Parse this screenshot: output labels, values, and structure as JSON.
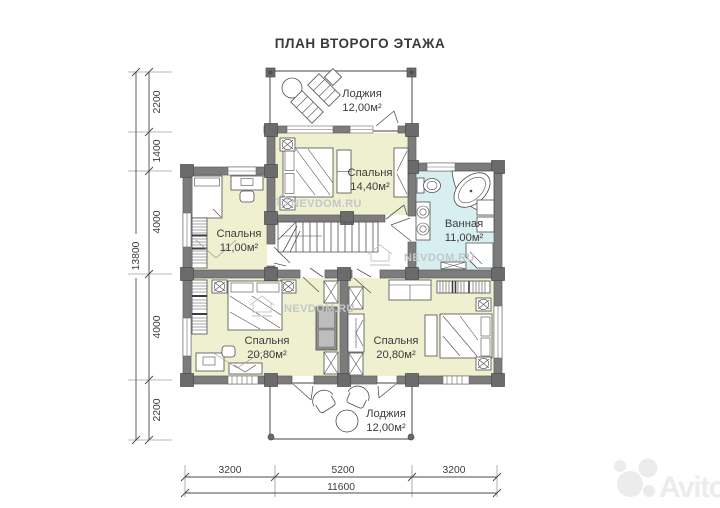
{
  "title": "ПЛАН ВТОРОГО ЭТАЖА",
  "colors": {
    "room_fill": "#eef0cf",
    "bath_fill": "#d7eff0",
    "wall": "#7c7c7c",
    "accent_text": "#3d3d3d",
    "watermark": "#c3c7c9"
  },
  "rooms": [
    {
      "id": "loggia-top",
      "name": "Лоджия",
      "area": "12,00м²"
    },
    {
      "id": "bedroom-top",
      "name": "Спальня",
      "area": "14,40м²"
    },
    {
      "id": "bathroom",
      "name": "Ванная",
      "area": "11,00м²"
    },
    {
      "id": "bedroom-left",
      "name": "Спальня",
      "area": "11,00м²"
    },
    {
      "id": "bedroom-bottom-left",
      "name": "Спальня",
      "area": "20,80м²"
    },
    {
      "id": "bedroom-bottom-right",
      "name": "Спальня",
      "area": "20,80м²"
    },
    {
      "id": "loggia-bottom",
      "name": "Лоджия",
      "area": "12,00м²"
    }
  ],
  "dimensions": {
    "left": {
      "segments": [
        "2200",
        "1400",
        "4000",
        "4000",
        "2200"
      ],
      "total": "13800"
    },
    "bottom": {
      "segments": [
        "3200",
        "5200",
        "3200"
      ],
      "total": "11600"
    }
  },
  "watermarks": {
    "site": "NEVDOM.RU",
    "brand": "Avito"
  }
}
